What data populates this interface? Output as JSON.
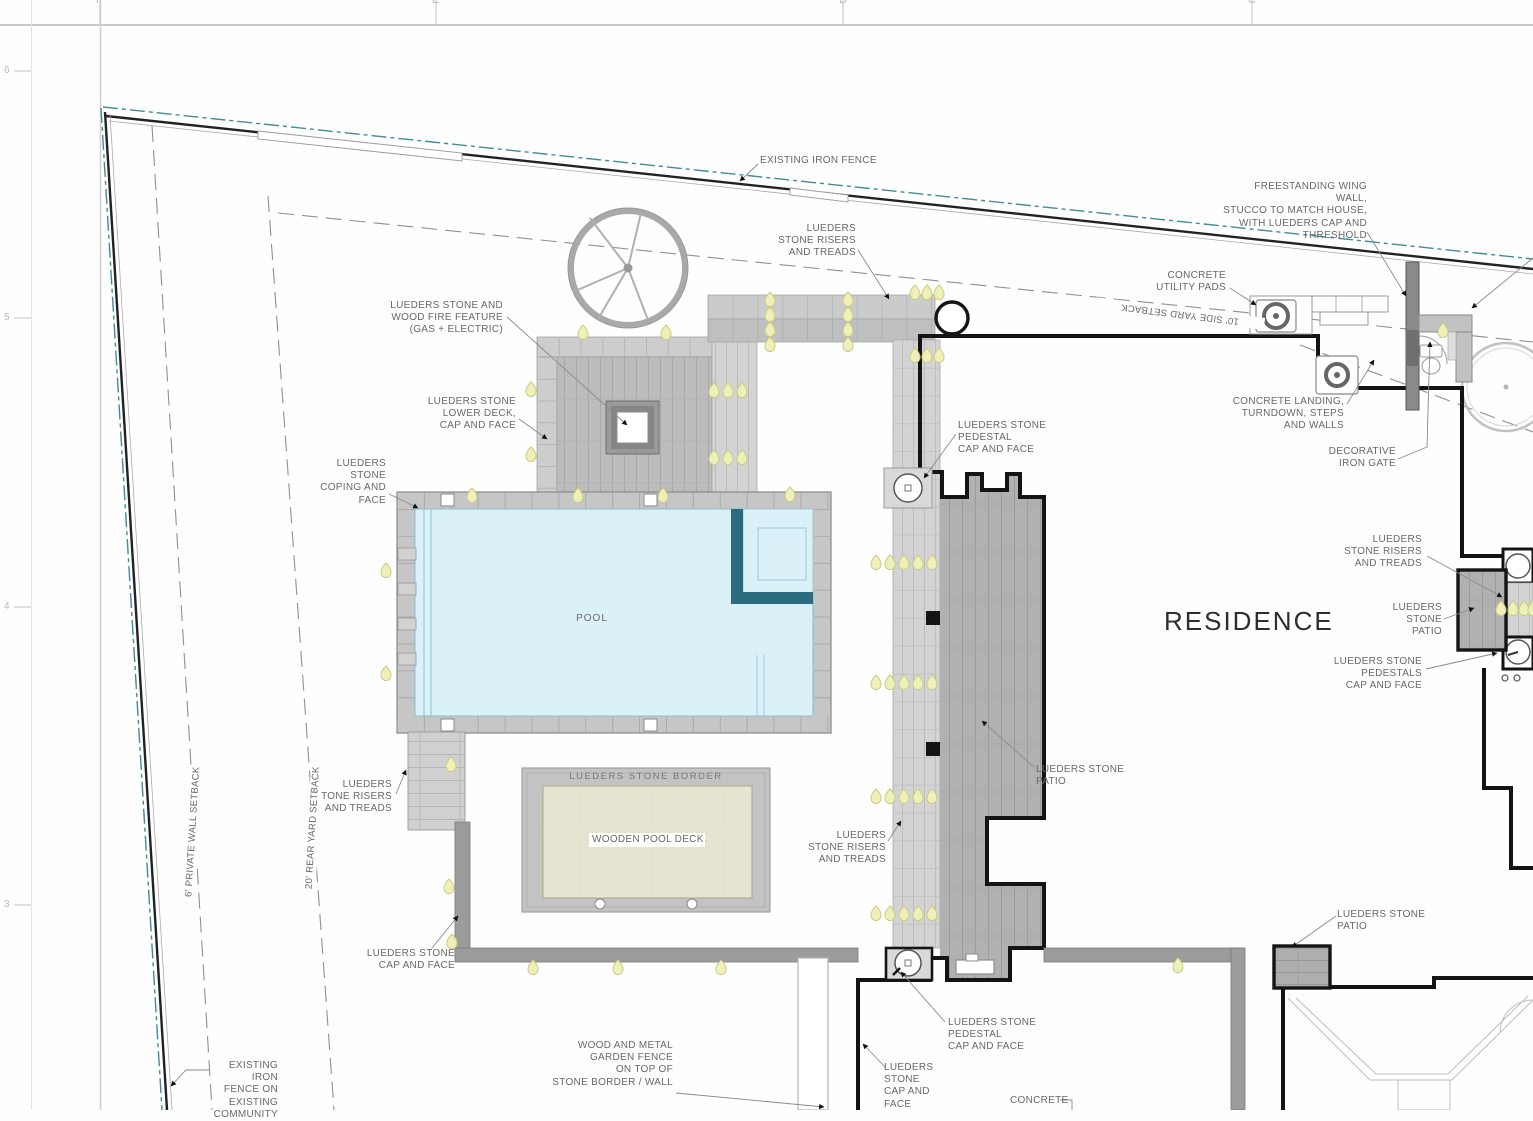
{
  "drawing": {
    "grid": {
      "columns": [
        "F",
        "E",
        "D",
        "C"
      ],
      "rows": [
        "6",
        "5",
        "4",
        "3"
      ]
    },
    "annotations": {
      "existing_iron_fence": "EXISTING IRON FENCE",
      "wing_wall": "FREESTANDING WING WALL,\nSTUCCO TO MATCH HOUSE,\nWITH LUEDERS CAP AND\nTHRESHOLD",
      "concrete_utility_pads": "CONCRETE\nUTILITY PADS",
      "side_yard_setback": "10'  SIDE  YARD  SETBACK",
      "fire_feature": "LUEDERS STONE AND\nWOOD FIRE FEATURE\n(GAS + ELECTRIC)",
      "stone_risers_treads": "LUEDERS\nSTONE RISERS\nAND TREADS",
      "lower_deck": "LUEDERS STONE\nLOWER DECK,\nCAP AND FACE",
      "coping": "LUEDERS\nSTONE\nCOPING AND\nFACE",
      "concrete_landing": "CONCRETE LANDING,\nTURNDOWN, STEPS\nAND WALLS",
      "iron_gate": "DECORATIVE\nIRON GATE",
      "pedestal_cap_face": "LUEDERS STONE\nPEDESTAL\nCAP AND FACE",
      "pool": "POOL",
      "residence": "RESIDENCE",
      "stone_patio_stacked": "LUEDERS\nSTONE\nPATIO",
      "pedestals_cap_face": "LUEDERS STONE\nPEDESTALS\nCAP AND FACE",
      "stone_patio": "LUEDERS STONE PATIO",
      "stone_border": "LUEDERS  STONE  BORDER",
      "wooden_pool_deck": "WOODEN POOL DECK",
      "cap_and_face": "LUEDERS STONE\nCAP AND FACE",
      "private_wall_setback": "6'  PRIVATE  WALL  SETBACK",
      "rear_yard_setback": "20'  REAR  YARD  SETBACK",
      "existing_fence_community": "EXISTING IRON\nFENCE ON\nEXISTING\nCOMMUNITY",
      "garden_fence": "WOOD AND METAL\nGARDEN FENCE\nON TOP OF\nSTONE BORDER / WALL",
      "cap_and_face_stacked": "LUEDERS\nSTONE\nCAP AND\nFACE",
      "concrete": "CONCRETE"
    },
    "colors": {
      "water": "#d9f1f7",
      "spa_wall": "#2b6b80",
      "boundary_line": "#3f8ba0",
      "wood_deck": "#e7e3d1",
      "stone_light": "#cdcdcd",
      "stone_mid": "#bcbcbc",
      "stone_dark": "#b1b1b1",
      "light_fixture": "#eef0b8",
      "wall_black": "#141414"
    }
  }
}
